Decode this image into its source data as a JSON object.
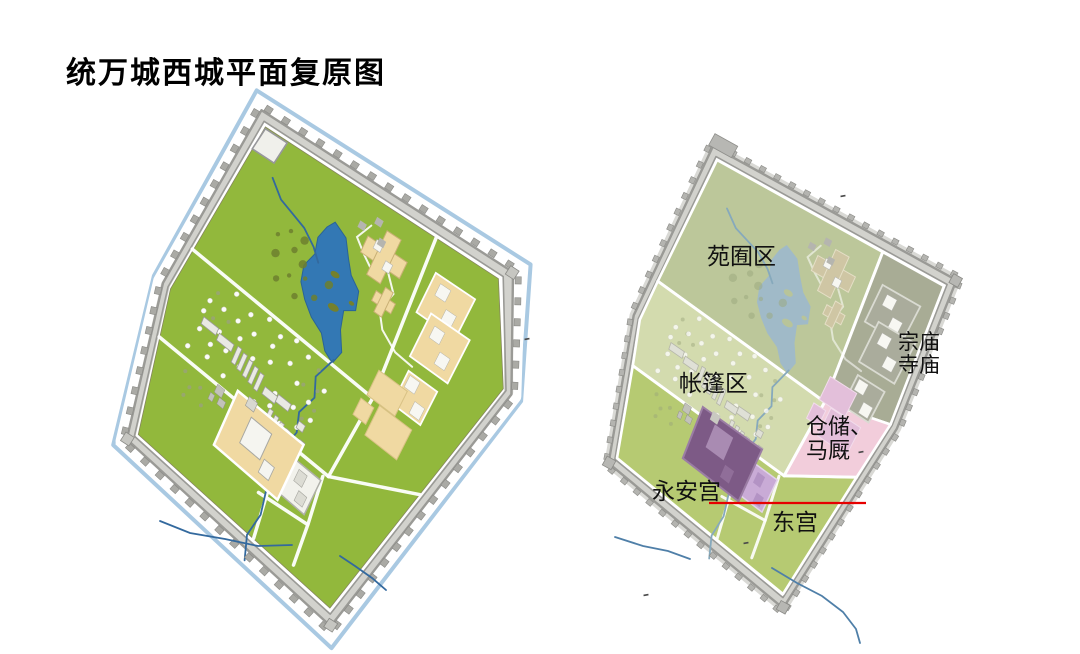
{
  "title": "统万城西城平面复原图",
  "right_map": {
    "labels": {
      "garden_zone": "苑囿区",
      "tent_zone": "帐篷区",
      "temple_zone_line1": "宗庙",
      "temple_zone_line2": "寺庙",
      "storage_zone_line1": "仓储、",
      "storage_zone_line2": "马厩",
      "yongan_palace": "永安宫",
      "east_palace": "东宫"
    }
  },
  "colors": {
    "background": "#ffffff",
    "title_text": "#000000",
    "label_text": "#111111",
    "moat_blue": "#a9c9e2",
    "wall_gray": "#9a9a96",
    "wall_band": "#d2d2cd",
    "tick_gray_left": "#aaaaa5",
    "tick_gray_right": "#b4b4b0",
    "grass_green": "#92b83c",
    "lake_blue": "#3378b4",
    "islet_olive": "#74802c",
    "stream_blue": "#33699e",
    "tree_olive": "#6d7f2e",
    "shrub_gray": "#9aa37b",
    "building_tan": "#f0d9a2",
    "building_roof": "#f7f7f2",
    "road_white": "#ffffff",
    "zone_garden": "#bcc79a",
    "zone_tent": "#d3dbae",
    "zone_temple": "#a8ac95",
    "zone_storage": "#f2cddb",
    "zone_palace_area": "#b6ca72",
    "muted_lake": "#a0bac8",
    "muted_stream": "#86a9bc",
    "muted_building": "#cfc6a4",
    "temple_building": "#aaac9c",
    "storage_building": "#e3bfda",
    "yongan_purple": "#7d5a86",
    "yongan_light": "#a98bb2",
    "donggong_lavender": "#c9abd6",
    "donggong_dark": "#b393c4",
    "red_line": "#e60000",
    "artifact_dark": "#4a4a4a"
  }
}
